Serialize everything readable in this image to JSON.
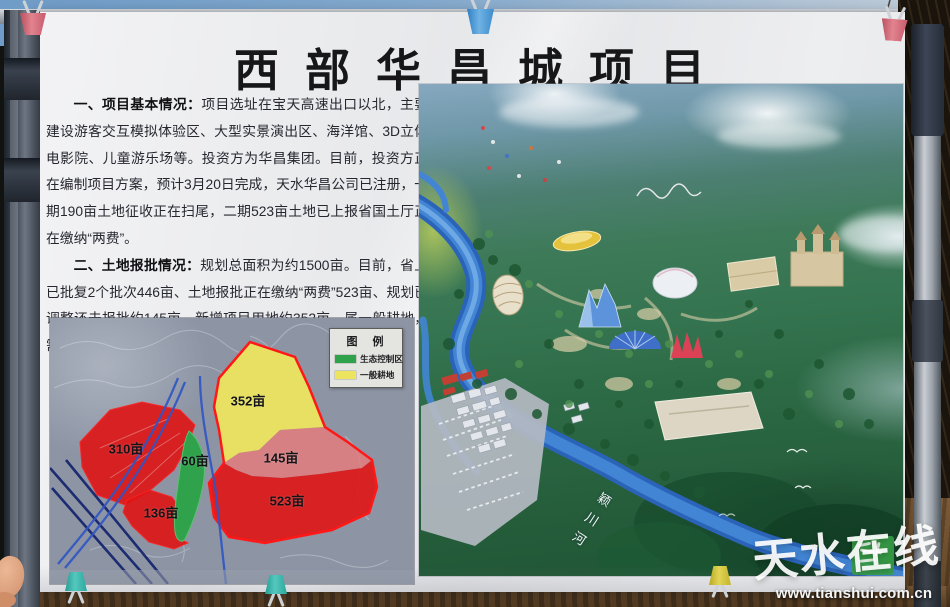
{
  "watermark": {
    "brand": "天水在线",
    "url": "www.tianshui.com.cn"
  },
  "poster": {
    "title": "西部华昌城项目",
    "sections": [
      {
        "heading": "一、项目基本情况：",
        "body": "项目选址在宝天高速出口以北，主要建设游客交互模拟体验区、大型实景演出区、海洋馆、3D立体电影院、儿童游乐场等。投资方为华昌集团。目前，投资方正在编制项目方案，预计3月20日完成，天水华昌公司已注册，一期190亩土地征收正在扫尾，二期523亩土地已上报省国土厅正在缴纳“两费”。"
      },
      {
        "heading": "二、土地报批情况：",
        "body": "规划总面积为约1500亩。目前，省上已批复2个批次446亩、土地报批正在缴纳“两费”523亩、规划已调整还未报批约145亩。新增项目用地约352亩，属一般耕地，需调整规划。原生态安全控制区约60亩，需调整规划。"
      }
    ],
    "land_map": {
      "legend_title": "图　例",
      "legend_items": [
        {
          "label": "生态控制区",
          "color": "#2fa24b"
        },
        {
          "label": "一般耕地",
          "color": "#ece45e"
        }
      ],
      "parcels": [
        {
          "label": "352亩",
          "color": "#ece45e"
        },
        {
          "label": "310亩",
          "color": "#df1414"
        },
        {
          "label": "145亩",
          "color": "#e87b7b"
        },
        {
          "label": "523亩",
          "color": "#df1414"
        },
        {
          "label": "136亩",
          "color": "#df1414"
        },
        {
          "label": "60亩",
          "color": "#2fa24b"
        }
      ]
    },
    "rendering": {
      "river_label": "颖川河"
    }
  }
}
